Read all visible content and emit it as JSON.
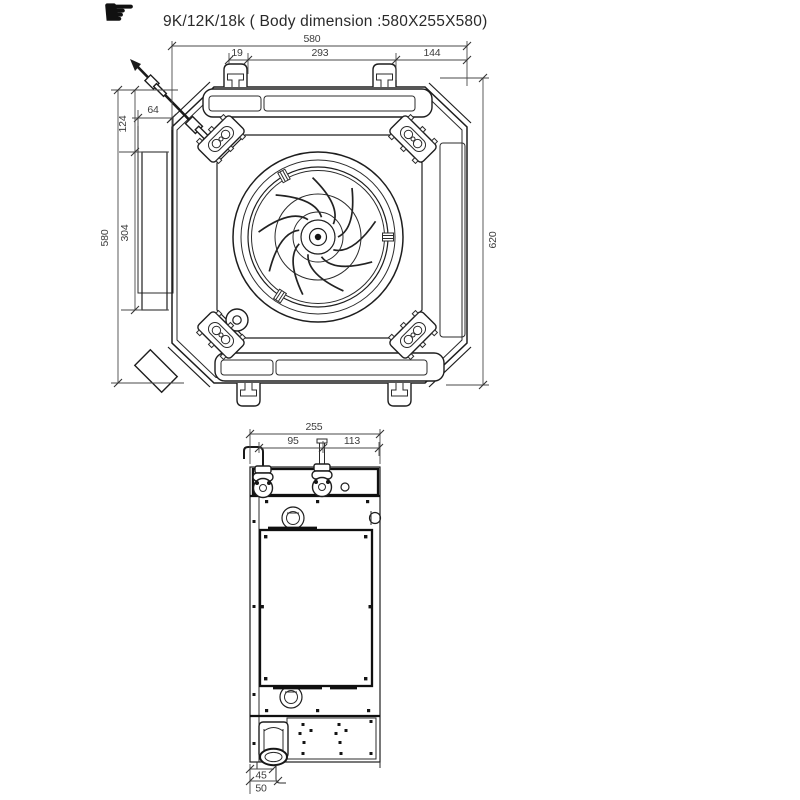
{
  "header": {
    "icon_glyph": "☛",
    "title": "9K/12K/18k ( Body dimension :580X255X580)"
  },
  "top_view": {
    "dim_total_width": "580",
    "dim_hanger_slot_offset": "19",
    "dim_hanger_pitch": "293",
    "dim_hanger_to_edge": "144",
    "dim_side_panel_depth": "64",
    "dim_top_offset": "124",
    "dim_total_height": "580",
    "dim_side_panel_length": "304",
    "dim_hanger_diagonal": "620"
  },
  "side_view": {
    "dim_total_depth": "255",
    "dim_pipe_spacing": "95",
    "dim_pipe_to_edge": "113",
    "dim_drain_offset": "45",
    "dim_drain_edge": "50"
  },
  "colors": {
    "background": "#ffffff",
    "line": "#1e1e1e",
    "dim_line": "#4a4a4a",
    "dim_text": "#3d3d3d",
    "title_text": "#2a2a2a"
  }
}
